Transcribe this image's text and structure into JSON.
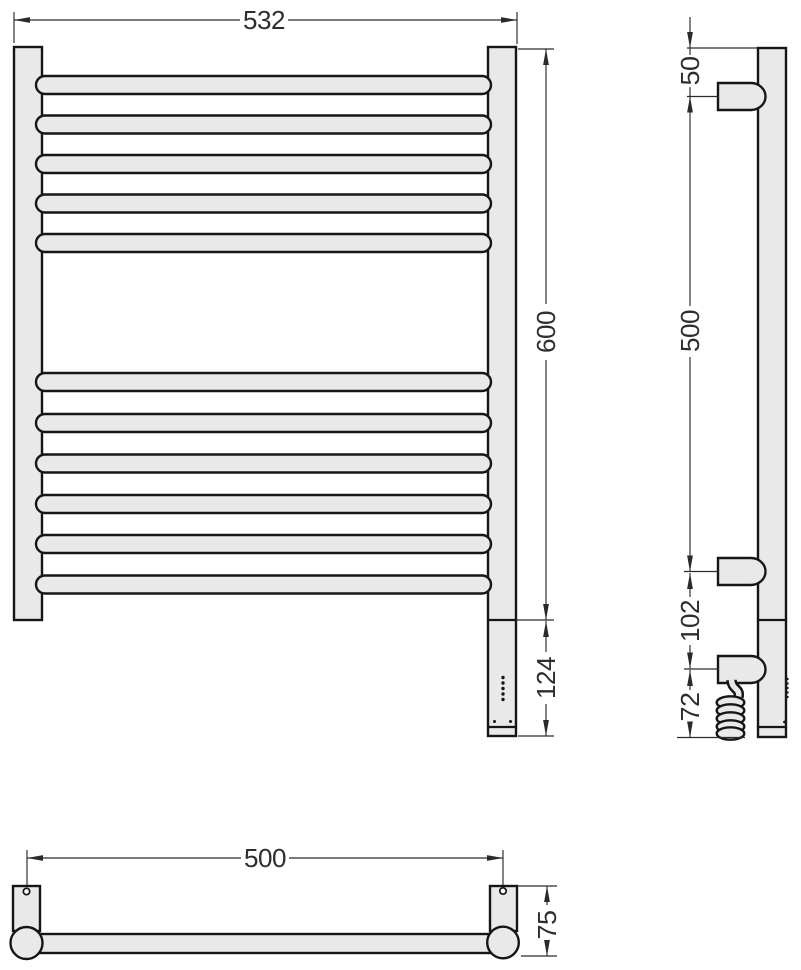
{
  "drawing": {
    "kind": "heated-towel-rail-dimension-drawing",
    "colors": {
      "body_fill": "#e9e9e9",
      "outline": "#161616",
      "dimension": "#2a2a2a"
    },
    "front": {
      "rung_count": 11,
      "dim_width": "532",
      "dim_height": "600",
      "dim_heater_section": "124"
    },
    "side": {
      "dim_top_to_bracket": "50",
      "dim_bracket_span": "500",
      "dim_bracket_to_cable": "102",
      "dim_cable_to_bottom": "72"
    },
    "plan": {
      "dim_mount_span": "500",
      "dim_depth": "75"
    }
  }
}
